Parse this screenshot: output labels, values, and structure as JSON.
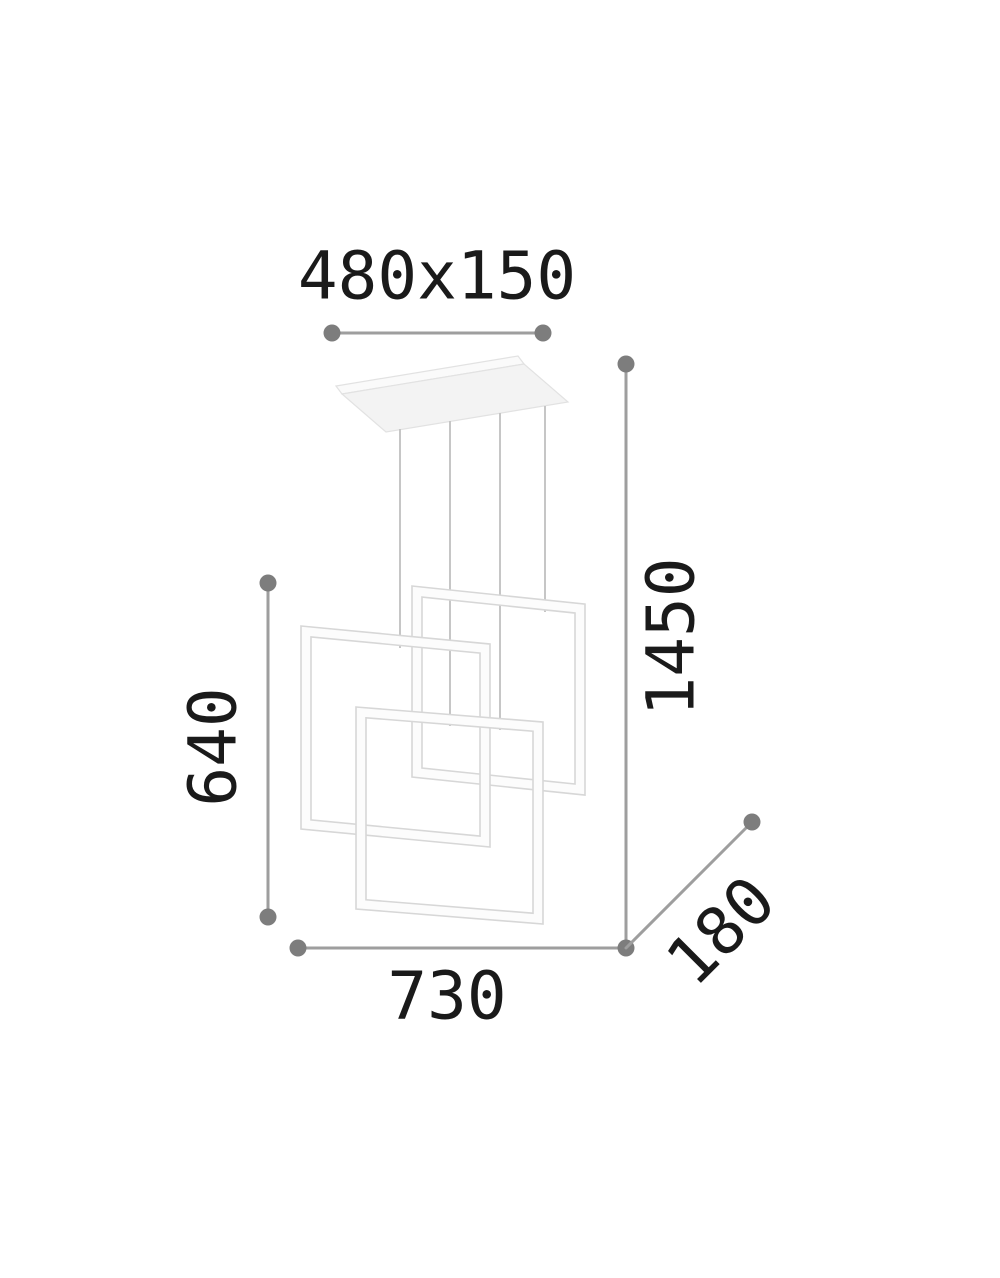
{
  "diagram": {
    "labels": {
      "canopy_size": "480x150",
      "overall_height": "1450",
      "fixture_height": "640",
      "width": "730",
      "depth": "180"
    }
  },
  "colors": {
    "background": "#ffffff",
    "dimension_line": "#9e9e9e",
    "dimension_dot": "#7d7d7d",
    "label_text": "#1a1a1a",
    "frame_stroke": "#d7d7d7",
    "frame_fill": "#fcfcfc",
    "wire": "#c6c6c6",
    "canopy_fill": "#f3f3f3",
    "canopy_stroke": "#e2e2e2"
  }
}
